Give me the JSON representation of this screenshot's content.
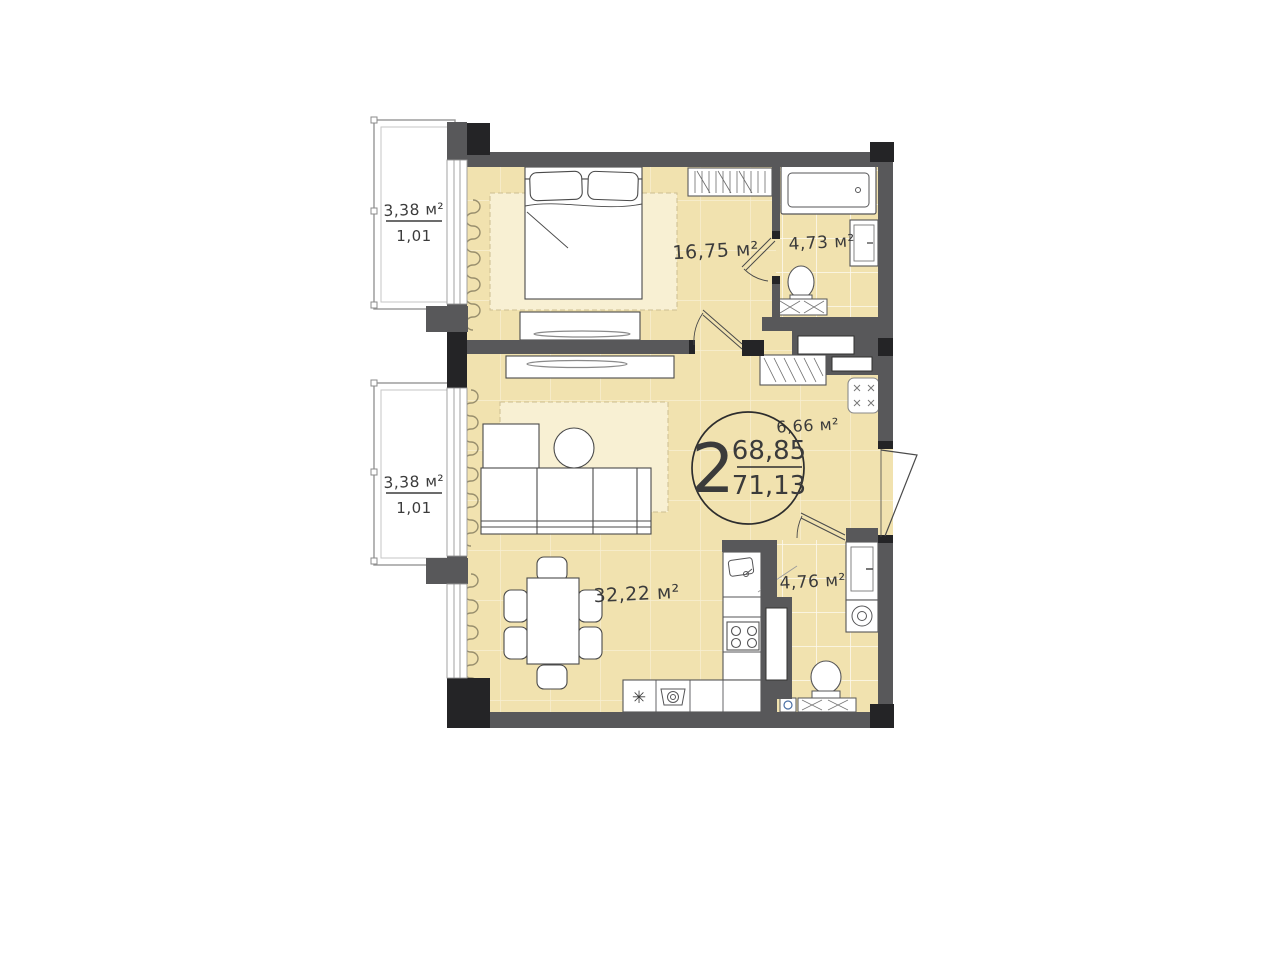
{
  "plan": {
    "type_badge": {
      "rooms_count": "2",
      "area_main": "68,85",
      "area_total": "71,13"
    },
    "rooms": {
      "bedroom": {
        "area_label": "16,75 м²"
      },
      "bathroom_top": {
        "area_label": "4,73 м²"
      },
      "hallway": {
        "area_label": "6,66 м²"
      },
      "living_kitchen": {
        "area_label": "32,22 м²"
      },
      "bathroom_bottom": {
        "area_label": "4,76 м²"
      }
    },
    "balconies": {
      "top": {
        "area_label": "3,38 м²",
        "coefficient_label": "1,01"
      },
      "bottom": {
        "area_label": "3,38 м²",
        "coefficient_label": "1,01"
      }
    },
    "symbols": {
      "kitchen_asterisk": "✳"
    },
    "colors": {
      "floor": "#F1E2AF",
      "rug": "#F8F0D3",
      "wall": "#58585A",
      "wall_corner": "#242426",
      "outline": "#3B3B3B"
    }
  }
}
